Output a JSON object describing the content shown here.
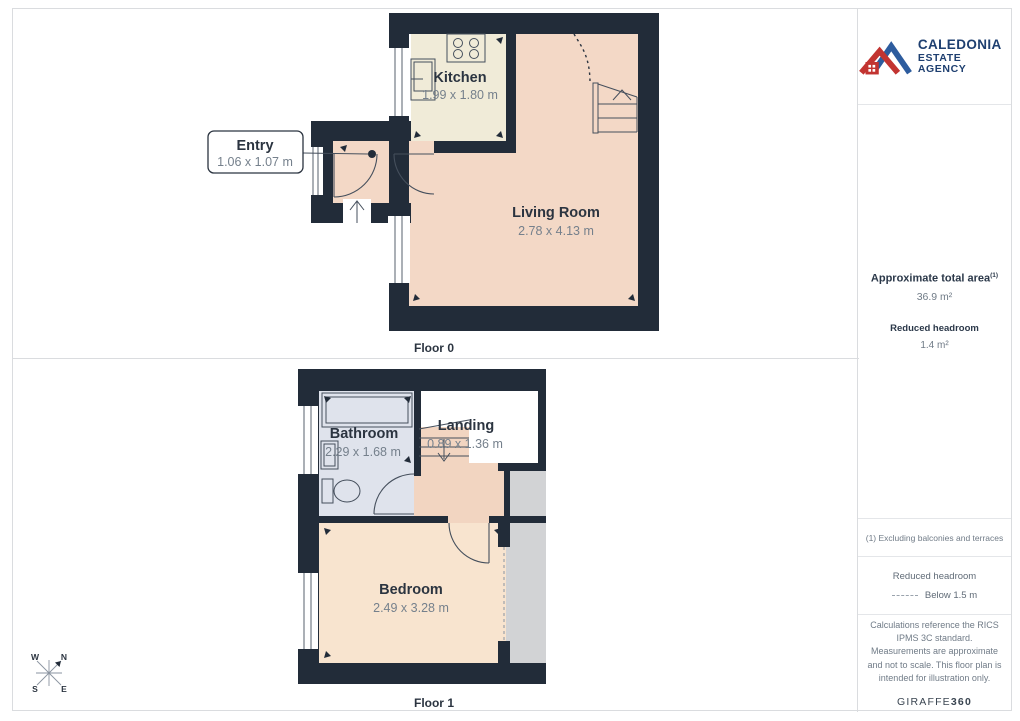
{
  "panels": {
    "floor0": {
      "label": "Floor 0",
      "rooms": {
        "kitchen": {
          "name": "Kitchen",
          "dims": "1.99 x 1.80 m"
        },
        "living": {
          "name": "Living Room",
          "dims": "2.78 x 4.13 m"
        }
      },
      "callout": {
        "name": "Entry",
        "dims": "1.06 x 1.07 m"
      }
    },
    "floor1": {
      "label": "Floor 1",
      "rooms": {
        "bathroom": {
          "name": "Bathroom",
          "dims": "2.29 x 1.68 m"
        },
        "landing": {
          "name": "Landing",
          "dims": "0.89 x 1.36 m"
        },
        "bedroom": {
          "name": "Bedroom",
          "dims": "2.49 x 3.28 m"
        }
      }
    }
  },
  "compass": {
    "n": "N",
    "s": "S",
    "e": "E",
    "w": "W"
  },
  "sidebar": {
    "logo": {
      "line1": "CALEDONIA",
      "line2": "ESTATE AGENCY"
    },
    "area": {
      "title": "Approximate total area",
      "superscript": "(1)",
      "value": "36.9 m²",
      "headroom_title": "Reduced headroom",
      "headroom_value": "1.4 m²"
    },
    "note": "(1) Excluding balconies and terraces",
    "legend": {
      "title": "Reduced headroom",
      "item": "Below 1.5 m"
    },
    "disclaimer": "Calculations reference the RICS IPMS 3C standard. Measurements are approximate and not to scale. This floor plan is intended for illustration only.",
    "brand": {
      "name": "GIRAFFE",
      "suffix": "360"
    }
  },
  "colors": {
    "wall": "#222c39",
    "living": "#f3d8c6",
    "kitchen": "#f0ebd8",
    "bathroom": "#dfe3ec",
    "bedroom": "#f8e4cf",
    "hall": "#f2d5c1",
    "gray": "#d2d3d5",
    "room-name": "#2b3440",
    "room-dims": "#75808c",
    "logo-red": "#c23431",
    "logo-blue": "#2d5c9e",
    "logo-text": "#1e3f70",
    "accent-text": "#2b3849",
    "muted-text": "#707b87"
  }
}
